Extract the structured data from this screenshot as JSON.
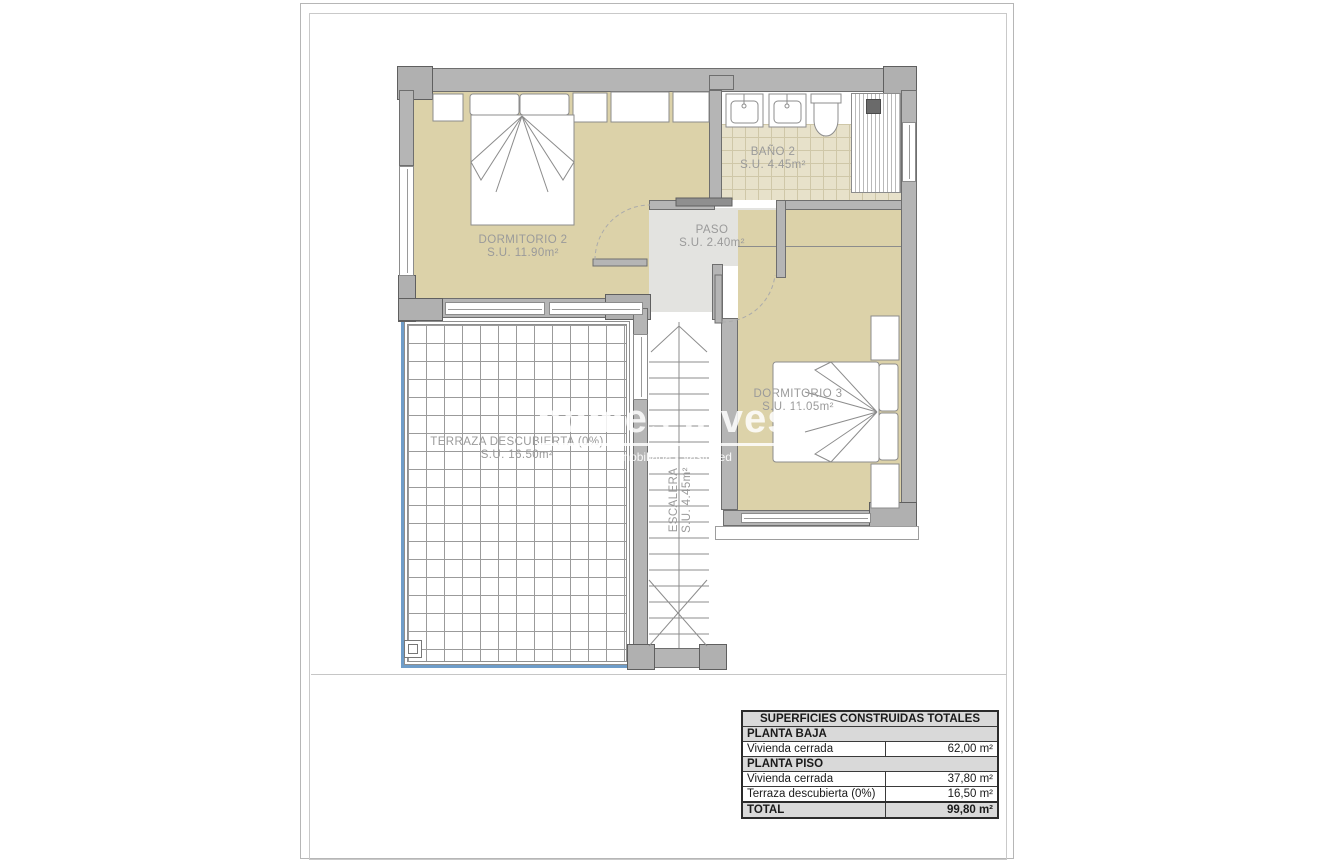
{
  "document": {
    "type": "floor-plan",
    "floor_shown": "PLANTA PISO"
  },
  "rooms": {
    "dormitorio2": {
      "name": "DORMITORIO 2",
      "area": "S.U. 11.90m²"
    },
    "bano2": {
      "name": "BAÑO 2",
      "area": "S.U. 4.45m²"
    },
    "paso": {
      "name": "PASO",
      "area": "S.U. 2.40m²"
    },
    "dormitorio3": {
      "name": "DORMITORIO 3",
      "area": "S.U. 11.05m²"
    },
    "terraza": {
      "name": "TERRAZA DESCUBIERTA (0%)",
      "area": "S.U. 16.50m²"
    },
    "escalera": {
      "name": "ESCALERA",
      "area": "S.U. 4.45m²"
    }
  },
  "watermark": {
    "brand": "homes invest",
    "tagline": "Inmobiliaria - Vastgoed"
  },
  "summary_table": {
    "title": "SUPERFICIES CONSTRUIDAS TOTALES",
    "rows": [
      {
        "label": "PLANTA BAJA",
        "value": ""
      },
      {
        "label": "Vivienda cerrada",
        "value": "62,00 m²"
      },
      {
        "label": "PLANTA PISO",
        "value": ""
      },
      {
        "label": "Vivienda cerrada",
        "value": "37,80 m²"
      },
      {
        "label": "Terraza descubierta (0%)",
        "value": "16,50 m²"
      },
      {
        "label": "TOTAL",
        "value": "99,80 m²"
      }
    ]
  },
  "colors": {
    "room_floor": "#dcd2a9",
    "bath_tile": "#e7e1ca",
    "wall": "#b5b5b5",
    "hall": "#e3e3e0",
    "terrace_edge_blue": "#6f9dc9",
    "label_text": "#9a9a9a",
    "table_header_bg": "#d9d9d9"
  }
}
